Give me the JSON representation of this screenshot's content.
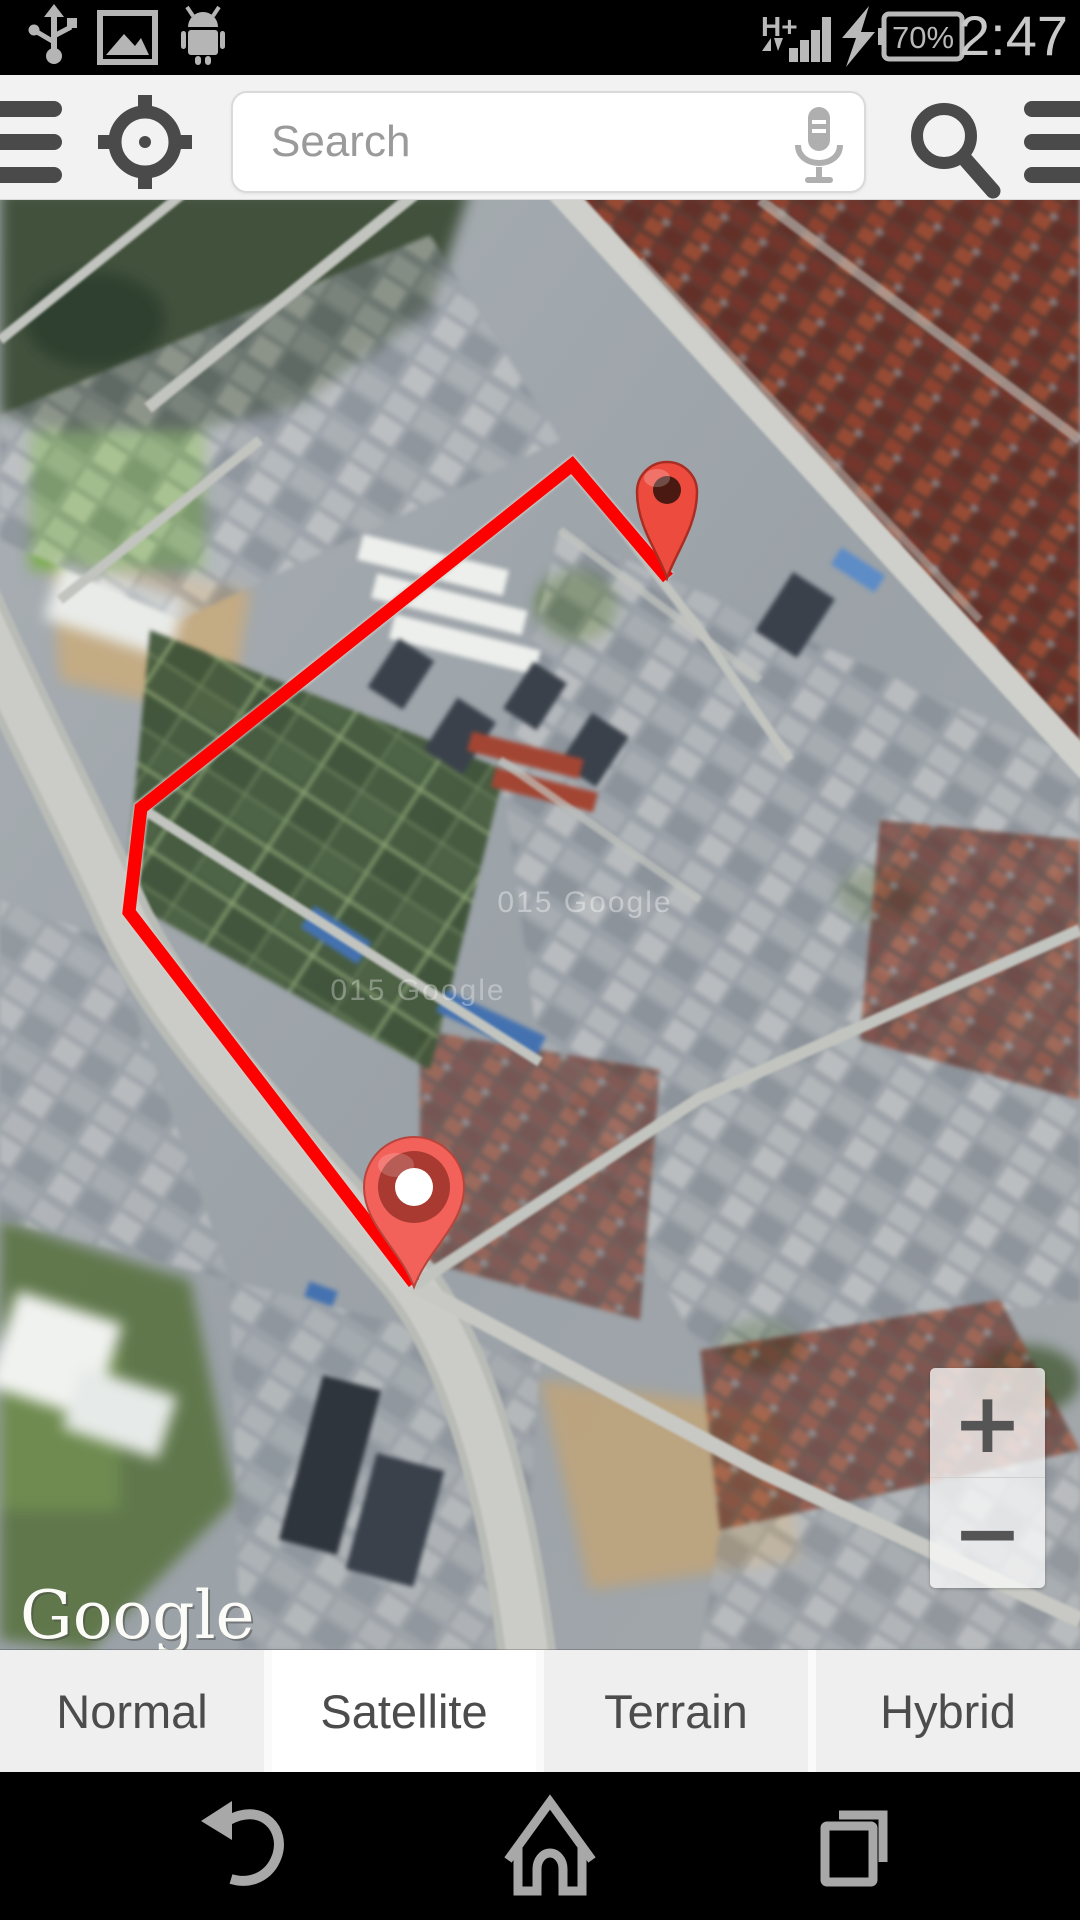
{
  "status_bar": {
    "time": "2:47",
    "battery_percent": "70%",
    "network_type": "H+",
    "icons": [
      "usb-icon",
      "gallery-icon",
      "android-icon",
      "signal-bars-icon",
      "charging-bolt-icon",
      "battery-icon"
    ]
  },
  "toolbar": {
    "search_placeholder": "Search",
    "icons": [
      "hamburger-menu-icon",
      "gps-locate-icon",
      "microphone-icon",
      "search-icon",
      "list-menu-icon"
    ]
  },
  "map": {
    "provider_logo": "Google",
    "watermark_1": "015 Google",
    "watermark_2": "015 Google",
    "route_color": "#fe0000",
    "route_points": "668,378 572,265 141,608 129,712 414,1083",
    "markers": {
      "destination": {
        "x": 667,
        "y": 378,
        "fill": "#ed4b3e",
        "dot": "#4a1a12"
      },
      "origin": {
        "x": 414,
        "y": 1087,
        "fill": "#f2625a",
        "ring": "#a83a31",
        "center": "#ffffff"
      }
    },
    "zoom_in_label": "+",
    "zoom_out_label": "−"
  },
  "tabs": [
    {
      "label": "Normal",
      "active": false
    },
    {
      "label": "Satellite",
      "active": true
    },
    {
      "label": "Terrain",
      "active": false
    },
    {
      "label": "Hybrid",
      "active": false
    }
  ],
  "nav_bar": {
    "back": "back-icon",
    "home": "home-icon",
    "recents": "recents-icon"
  }
}
